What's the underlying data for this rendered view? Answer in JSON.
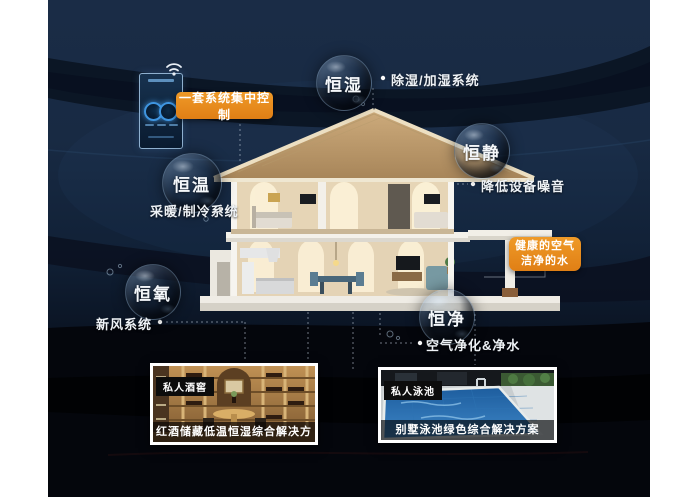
{
  "control_panel": {
    "label": "一套系统集中控制",
    "device": "smart-control-panel",
    "icon": "wifi-icon"
  },
  "bubbles": [
    {
      "id": "heng-shi",
      "label": "恒湿",
      "annotation": "除湿/加湿系统"
    },
    {
      "id": "heng-jing",
      "label": "恒静",
      "annotation": "降低设备噪音"
    },
    {
      "id": "heng-wen",
      "label": "恒温",
      "annotation": "采暖/制冷系统"
    },
    {
      "id": "heng-yang",
      "label": "恒氧",
      "annotation": "新风系统"
    },
    {
      "id": "heng-jing-water",
      "label": "恒净",
      "annotation": "空气净化&净水"
    }
  ],
  "highlight_box": {
    "line1": "健康的空气",
    "line2": "洁净的水"
  },
  "cards": [
    {
      "tag": "私人酒窖",
      "caption": "红酒储藏低温恒湿综合解决方案"
    },
    {
      "tag": "私人泳池",
      "caption": "别墅泳池绿色综合解决方案"
    }
  ],
  "colors": {
    "accent_orange": "#e6861c",
    "background_navy": "#16283f",
    "bubble_rim": "#96aec6"
  },
  "icons": {
    "wifi": "wifi-icon"
  }
}
